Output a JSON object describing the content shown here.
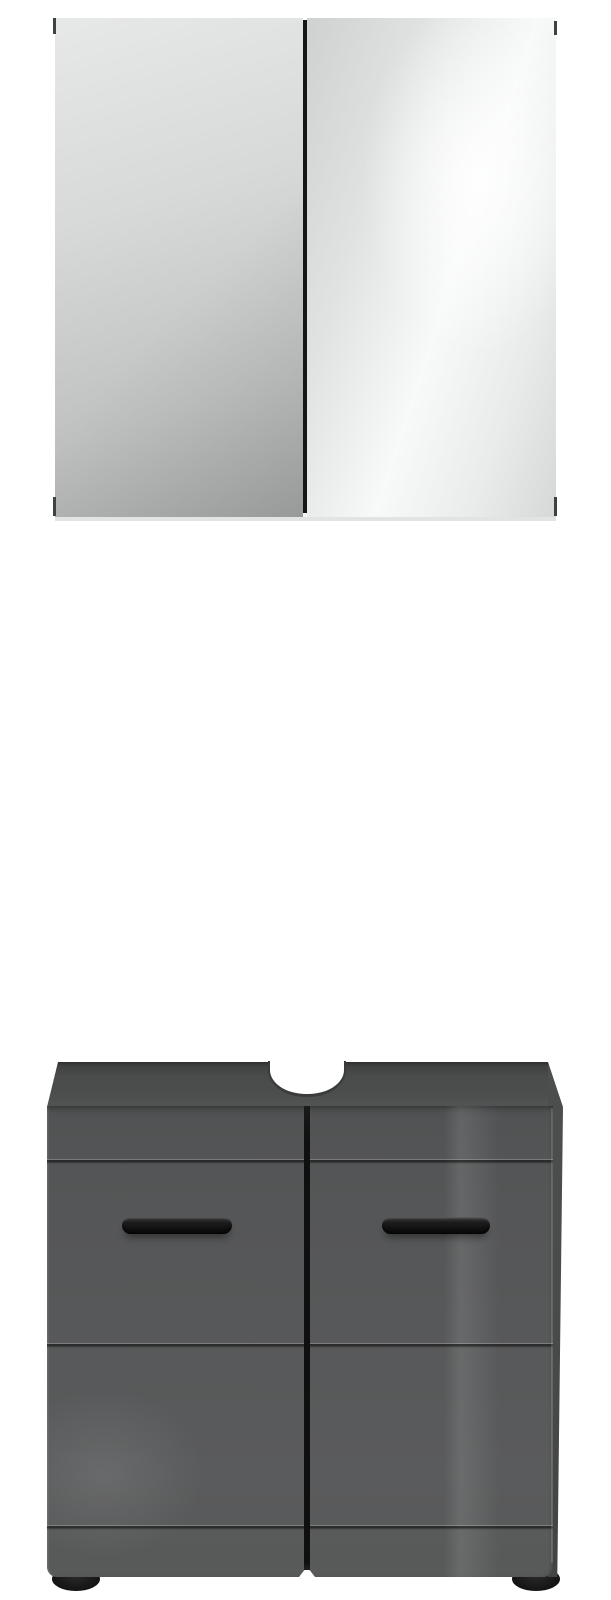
{
  "scene": {
    "type": "product-photo",
    "description": "Bathroom furniture set on white background: mirror wall cabinet above, washbasin base cabinet below",
    "items": [
      {
        "id": "mirror-cabinet",
        "label": "two-door mirror wall cabinet",
        "doors": 2,
        "finish": "mirrored glass"
      },
      {
        "id": "vanity-cabinet",
        "label": "two-door washbasin base cabinet with siphon cutout",
        "doors": 2,
        "handles": 2,
        "feet": 2,
        "finish": "grey high gloss"
      }
    ]
  },
  "palette": {
    "bg": "#ffffff",
    "mirror-left-a": "#e7e8e8",
    "mirror-left-b": "#d7d9d9",
    "mirror-left-c": "#bfc1c1",
    "mirror-left-d": "#a9abab",
    "mirror-right-a": "#cfd1d1",
    "mirror-right-b": "#f8f9f9",
    "mirror-right-c": "#d6d8d8",
    "mirror-gap": "#161616",
    "mirror-strip": "#e2e3e3",
    "mirror-tick": "#3f4142",
    "top-edge": "#2e2f2f",
    "top-face": "#4a4b4b",
    "top-front": "#525353",
    "side-face": "#4a4b4b",
    "front-top": "#515253",
    "front-mid": "#575859",
    "front-low": "#585959",
    "gap": "#0f0f10",
    "handle": "#101011",
    "handle-rim": "#3e3e3f",
    "foot": "#141415",
    "cut-line": "#3a3b3c"
  }
}
